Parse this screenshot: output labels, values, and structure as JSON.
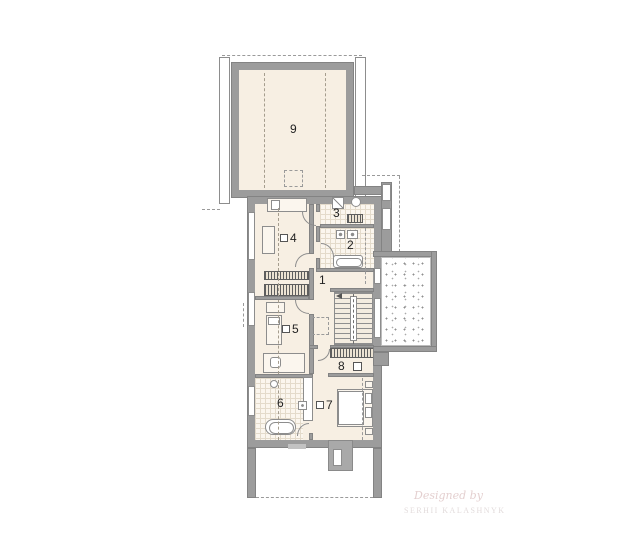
{
  "plan_title": "second-floor-plan",
  "rooms": {
    "r1": {
      "number": "1"
    },
    "r2": {
      "number": "2"
    },
    "r3": {
      "number": "3"
    },
    "r4": {
      "number": "4"
    },
    "r5": {
      "number": "5"
    },
    "r6": {
      "number": "6"
    },
    "r7": {
      "number": "7"
    },
    "r8": {
      "number": "8"
    },
    "r9": {
      "number": "9"
    }
  },
  "watermark": {
    "line1": "Designed by",
    "line2": "SERHII KALASHNYK"
  },
  "colors": {
    "wall": "#9c9c9c",
    "floor": "#f7efe3",
    "tile_line": "#e4dbcb",
    "speckle_dot": "#8f8f8f"
  },
  "icons": {
    "bed": "rect-with-pillow",
    "wardrobe": "hatched-rect",
    "staircase": "treaded-rect-with-walkline",
    "bathtub": "rounded-rect",
    "toilet": "small-rect-dot",
    "sink": "circle",
    "washing-machine": "square-with-diagonal",
    "shower-drain": "square-with-dot",
    "chimney": "gray-block-with-flue",
    "terrace": "stippled-area",
    "floor-marker": "small-square"
  }
}
